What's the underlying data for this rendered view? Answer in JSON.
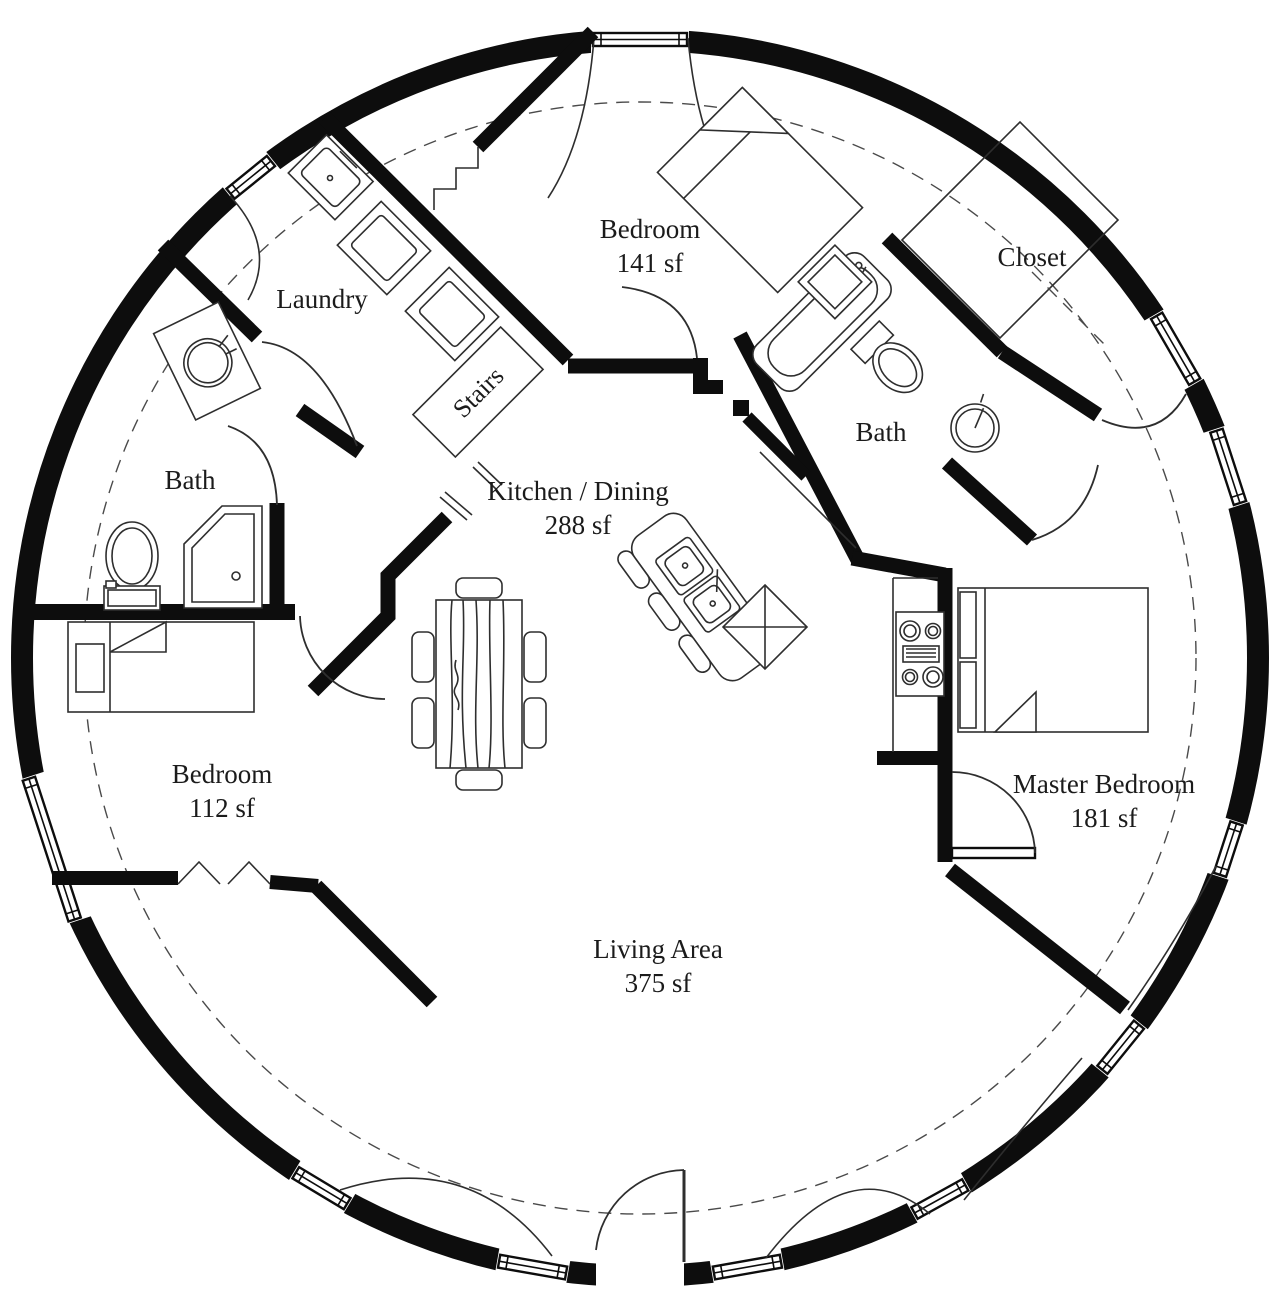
{
  "plan": {
    "title": "Circular dome home floor plan",
    "rooms": [
      {
        "id": "laundry",
        "label": "Laundry",
        "area": ""
      },
      {
        "id": "bedroom-top",
        "label": "Bedroom",
        "area": "141 sf"
      },
      {
        "id": "closet",
        "label": "Closet",
        "area": ""
      },
      {
        "id": "bath-right",
        "label": "Bath",
        "area": ""
      },
      {
        "id": "stairs",
        "label": "Stairs",
        "area": ""
      },
      {
        "id": "kitchen-dining",
        "label": "Kitchen / Dining",
        "area": "288 sf"
      },
      {
        "id": "bath-left",
        "label": "Bath",
        "area": ""
      },
      {
        "id": "bedroom-left",
        "label": "Bedroom",
        "area": "112 sf"
      },
      {
        "id": "master-bedroom",
        "label": "Master Bedroom",
        "area": "181 sf"
      },
      {
        "id": "living-area",
        "label": "Living Area",
        "area": "375 sf"
      }
    ],
    "colors": {
      "wall": "#0d0d0d",
      "line": "#2e2e2e",
      "text": "#1b1b1b",
      "background": "#ffffff"
    }
  }
}
